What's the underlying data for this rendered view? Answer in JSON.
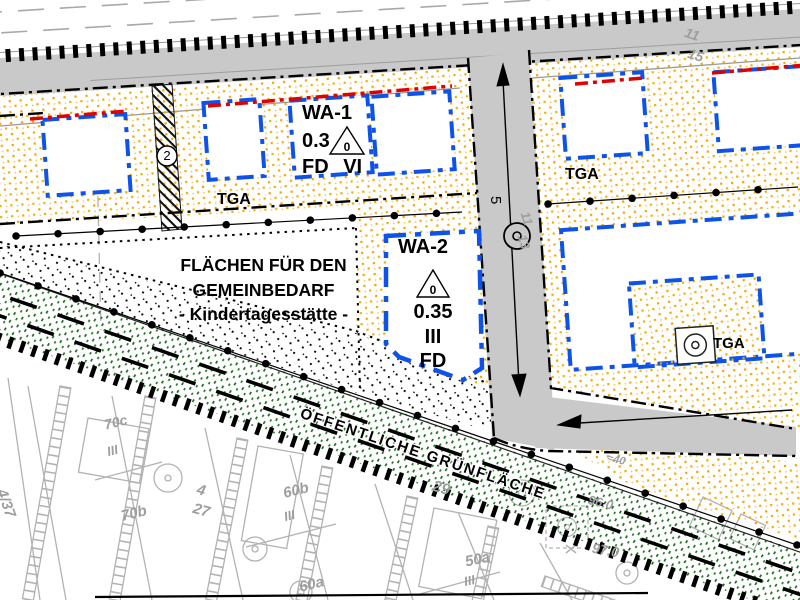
{
  "plan": {
    "wa1": {
      "name": "WA-1",
      "grz": "0.3",
      "roof_pitch": "0",
      "floors_roof": "FD VI"
    },
    "wa2": {
      "name": "WA-2",
      "roof_pitch": "0",
      "grz": "0.35",
      "floors": "III",
      "roof": "FD"
    },
    "gemeinbedarf": {
      "line1": "FLÄCHEN FÜR DEN",
      "line2": "GEMEINBEDARF",
      "line3": "- Kindertagesstätte -"
    },
    "green_area_label": "ÖFFENTLICHE GRÜNFLÄCHE",
    "tga": {
      "left": "TGA",
      "right": "TGA",
      "block": "TGA"
    },
    "symbols": {
      "path_number": "2",
      "street_width": "5"
    },
    "parcels": {
      "p4_37": "4/37",
      "p4_27_a": "4",
      "p4_27_b": "27",
      "p70c": "70c",
      "p70c_fl": "III",
      "p70b": "70b",
      "p60b": "60b",
      "p60b_fl": "III",
      "p60a": "60a",
      "p50a": "50a",
      "p50a_fl": "III",
      "p29": "29",
      "p96": "96.0",
      "p97": "97.0",
      "p40": "≈40",
      "p11a": "11",
      "p15": "15",
      "p11b": "11",
      "p13": "13"
    }
  },
  "colors": {
    "building_boundary_blue": "#0d53ea",
    "building_line_red": "#df0000",
    "residential_stipple_orange": "#f0a500",
    "green_space": "#1b6e1b",
    "road_gray": "#c9c9c9",
    "cadastral_gray": "#b2b2b2"
  }
}
